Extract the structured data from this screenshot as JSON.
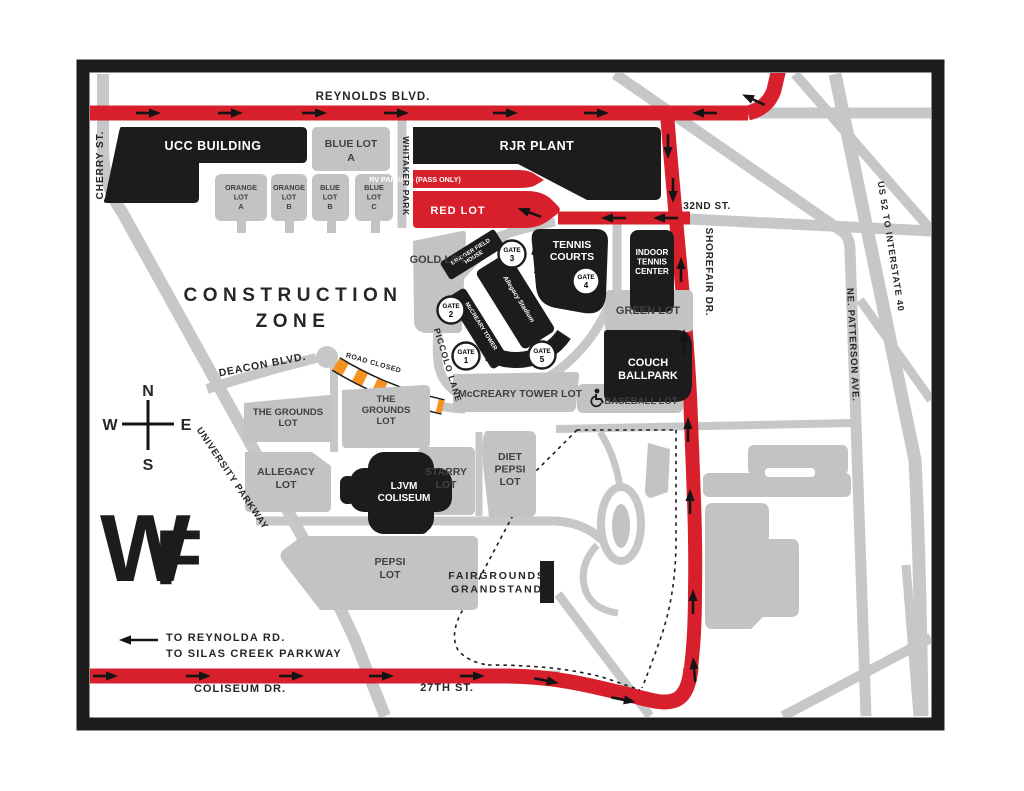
{
  "map": {
    "colors": {
      "route_red": "#d7202b",
      "road_gray": "#c6c7c9",
      "building_black": "#1c1c1c",
      "closed_orange": "#f69320"
    },
    "roads": {
      "reynolds": "REYNOLDS BLVD.",
      "cherry": "CHERRY ST.",
      "whitaker": "WHITAKER PARK",
      "thirty_second": "32ND ST.",
      "shorefair": "SHOREFAIR DR.",
      "us52": "US 52 TO INTERSTATE 40",
      "patterson": "NE. PATTERSON AVE.",
      "deacon": "DEACON BLVD.",
      "piccolo": "PICCOLO LANE",
      "university": "UNIVERSITY PARKWAY",
      "coliseum": "COLISEUM DR.",
      "twenty_seventh": "27TH ST."
    },
    "buildings": {
      "ucc": "UCC BUILDING",
      "rjr": "RJR PLANT",
      "tennis_courts": [
        "TENNIS",
        "COURTS"
      ],
      "indoor_tennis": [
        "INDOOR",
        "TENNIS",
        "CENTER"
      ],
      "couch": [
        "COUCH",
        "BALLPARK"
      ],
      "ljvm": [
        "LJVM",
        "COLISEUM"
      ],
      "bridger": [
        "BRIDGER FIELD",
        "HOUSE"
      ],
      "mccreary_tower": "McCREARY TOWER",
      "stadium_logo": "Allegacy Stadium"
    },
    "lots": {
      "blue_a": [
        "BLUE LOT",
        "A"
      ],
      "orange_a": [
        "ORANGE",
        "LOT",
        "A"
      ],
      "orange_b": [
        "ORANGE",
        "LOT",
        "B"
      ],
      "blue_b": [
        "BLUE",
        "LOT",
        "B"
      ],
      "blue_c": [
        "BLUE",
        "LOT",
        "C"
      ],
      "gold": "GOLD LOT",
      "red": "RED LOT",
      "rv": "RV PARKING (PASS ONLY)",
      "green": "GREEN LOT",
      "mccreary": "McCREARY TOWER LOT",
      "baseball": "BASEBALL LOT",
      "grounds_w": [
        "THE GROUNDS",
        "LOT"
      ],
      "grounds_e": [
        "THE",
        "GROUNDS",
        "LOT"
      ],
      "allegacy": [
        "ALLEGACY",
        "LOT"
      ],
      "starry": [
        "STARRY",
        "LOT"
      ],
      "diet_pepsi": [
        "DIET",
        "PEPSI",
        "LOT"
      ],
      "pepsi": [
        "PEPSI",
        "LOT"
      ],
      "fairgrounds": [
        "FAIRGROUNDS",
        "GRANDSTAND"
      ]
    },
    "gates": [
      {
        "label": "GATE",
        "number": "1"
      },
      {
        "label": "GATE",
        "number": "2"
      },
      {
        "label": "GATE",
        "number": "3"
      },
      {
        "label": "GATE",
        "number": "4"
      },
      {
        "label": "GATE",
        "number": "5"
      }
    ],
    "zones": {
      "construction": [
        "CONSTRUCTION",
        "ZONE"
      ],
      "road_closed": "ROAD CLOSED",
      "to_reynolda": "TO REYNOLDA RD.",
      "to_silas": "TO SILAS CREEK PARKWAY"
    },
    "compass": {
      "n": "N",
      "s": "S",
      "e": "E",
      "w": "W"
    },
    "wf_logo": {
      "w": "W",
      "f": "F"
    }
  }
}
